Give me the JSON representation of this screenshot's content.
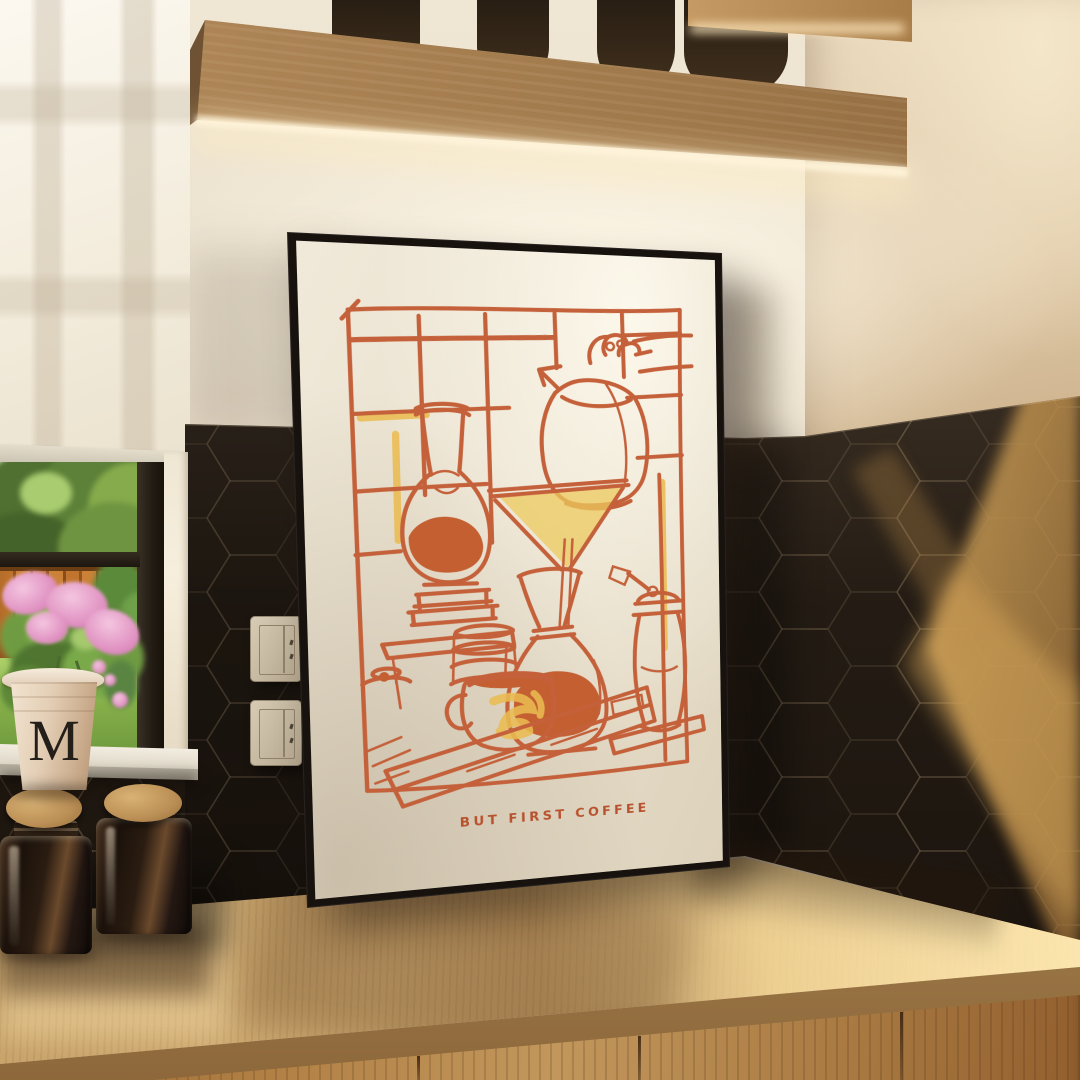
{
  "poster": {
    "caption": "BUT FIRST COFFEE",
    "subject": "hand-drawn pour-over coffee scene",
    "colors": {
      "ink_orange": "#c4613a",
      "accent_yellow": "#e9bb51",
      "paper": "#eae1cf",
      "frame": "#17120e"
    }
  },
  "flower_pot": {
    "monogram": "M"
  },
  "palette": {
    "wall_cream": "#e9dfcd",
    "wall_right_warm": "#dfc9a8",
    "tile_dark": "#261f18",
    "tile_sunlight": "#caa35d",
    "counter_wood": "#c6a269",
    "cabinet_wood": "#a97a42",
    "shelf_wood": "#a37c4e",
    "led_glow": "#fff4da",
    "garden_green": "#85ae49",
    "fence_orange": "#c0752e",
    "flower_pink": "#df8fc0",
    "cork_tan": "#bb8f55"
  }
}
